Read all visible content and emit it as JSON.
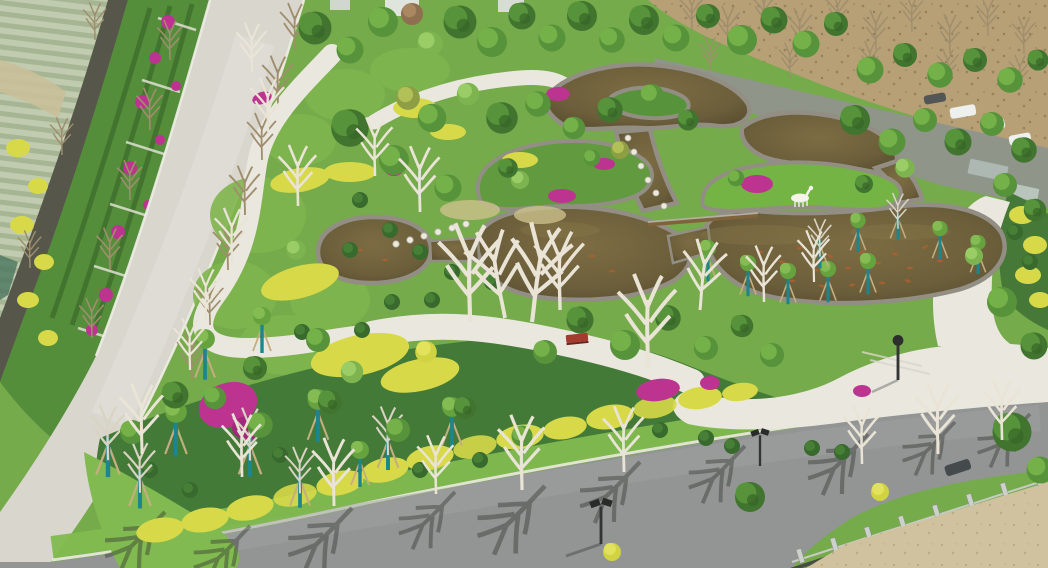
{
  "scene": {
    "caption": "Aerial drone view of a landscaped park with a winding koi pond, flowering shrubs, lawns and perimeter roads",
    "type": "aerial-photograph",
    "visible_text": "none"
  },
  "palette": {
    "grass_base": "#6fa844",
    "grass_bright": "#7cb84a",
    "grass_light": "#8fc45a",
    "foliage_dark": "#386f28",
    "foliage_mid": "#4f8f33",
    "foliage_light": "#79b24a",
    "shrub_dark": "#3b7430",
    "yellow_hedge": "#d6d843",
    "yellow_flowers": "#e3c93c",
    "magenta_flowers": "#bb2a8e",
    "path_white": "#eae8e0",
    "road_light": "#d9d5cf",
    "asphalt": "#8f9193",
    "stone_edge": "#8e8a80",
    "pond_water_light": "#77663c",
    "pond_water": "#655733",
    "pond_deep": "#4a3f27",
    "koi_orange": "#a85a28",
    "farmland": "#bfcaae",
    "farm_row": "#a3b391",
    "wall_dark": "#4e4f45",
    "dirt_field": "#b59c72",
    "sand": "#cfc09e",
    "fence_dark": "#3f453f",
    "fence_post": "#ccd0cc",
    "tree_stake_teal": "#138089",
    "bare_branch_white": "#e9e4d7",
    "bare_branch_brown": "#9b8a6a",
    "shadow": "#2e322e",
    "lamp_dark": "#232425",
    "deer_white": "#f6f4ec",
    "bench_red": "#a03226",
    "vehicle_white": "#eef1ef",
    "shed_roof": "#a9b6b0",
    "building_light": "#dfe4df"
  },
  "objects": {
    "pond": "multi-lobed koi pond with stone edging",
    "deer_statue": "white deer sculpture on pond peninsula",
    "stepping_stones": "rows of stepping stones crossing the pond",
    "weir": "stone weir across pond narrows",
    "bench": "red garden bench",
    "lamps": "solar street lamps",
    "staked_trees": "young trees with teal trunk guards and support stakes",
    "bougainvillea": "magenta bougainvillea clusters",
    "hedges": "golden privet hedge bands",
    "farmland": "crop fields outside the park wall",
    "terraces": "terraced flower beds along boundary wall",
    "left_road": "light concrete perimeter road",
    "bottom_road": "asphalt road with bare-tree shadows",
    "fence": "iron fence with concrete posts",
    "sand_strip": "bare sandy ground beyond fence",
    "dirt_field": "brown field with rows of saplings",
    "vehicles": "cars parked near top-right road",
    "plaza": "white paved plaza and walking paths"
  }
}
